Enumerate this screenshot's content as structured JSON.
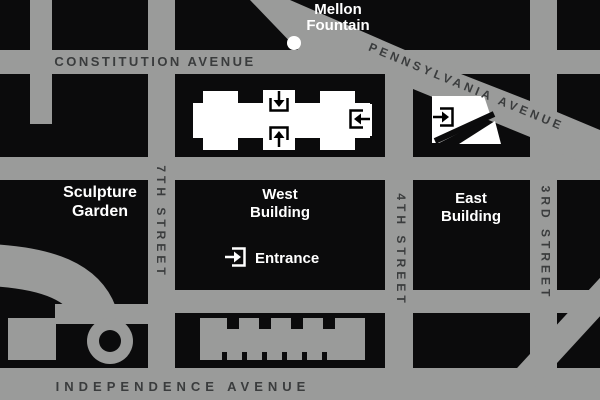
{
  "streets": {
    "constitution_avenue": "CONSTITUTION AVENUE",
    "pennsylvania_avenue": "PENNSYLVANIA AVENUE",
    "independence_avenue": "INDEPENDENCE AVENUE",
    "seventh_street": "7TH STREET",
    "fourth_street": "4TH STREET",
    "third_street": "3RD STREET"
  },
  "places": {
    "mellon_fountain": {
      "line1": "Mellon",
      "line2": "Fountain"
    },
    "sculpture_garden": {
      "line1": "Sculpture",
      "line2": "Garden"
    },
    "west_building": {
      "line1": "West",
      "line2": "Building"
    },
    "east_building": {
      "line1": "East",
      "line2": "Building"
    }
  },
  "legend": {
    "entrance_label": "Entrance"
  },
  "icons": {
    "entrance_legend": "arrow-right-into-bracket",
    "west_north_entrance": "arrow-down-into-bracket",
    "west_south_entrance": "arrow-up-into-bracket",
    "west_east_entrance": "arrow-left-into-bracket",
    "east_entrance": "arrow-right-into-bracket"
  },
  "colors": {
    "street": "#9a9b9a",
    "block": "#0b0b0c",
    "white": "#ffffff",
    "dark_label": "#3a3c3d"
  }
}
